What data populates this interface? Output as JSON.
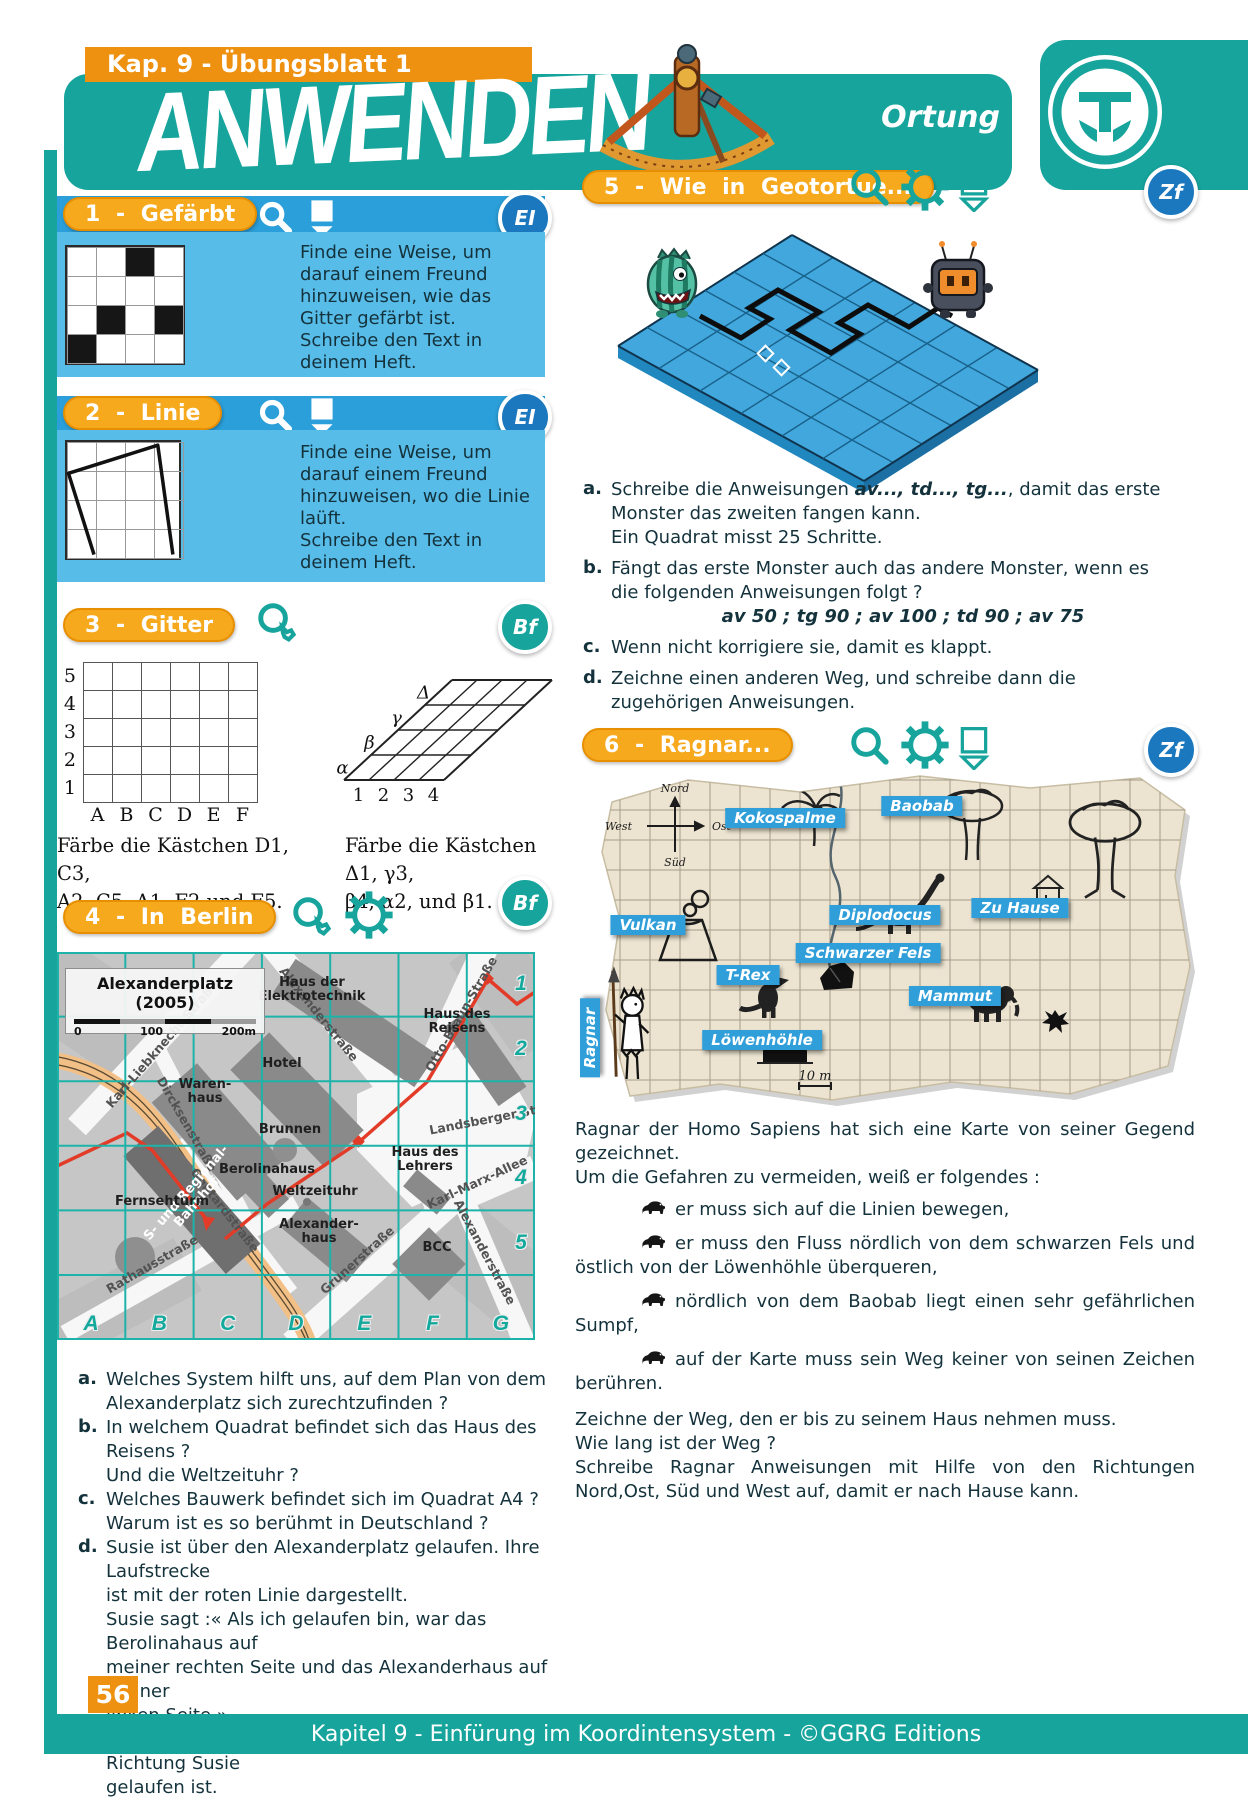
{
  "page": {
    "banner": "Kap. 9 - Übungsblatt 1",
    "title": "ANWENDEN",
    "subtitle": "Ortung",
    "page_number": "56",
    "footer": "Kapitel 9 - Einfürung im Koordintensystem - ©GGRG Editions"
  },
  "palette": {
    "teal": "#16a49c",
    "orange": "#ef9110",
    "pill": "#f6a91d",
    "blue_bar": "#2b9fd9",
    "blue_box": "#58bce8",
    "badge_blue": "#1b78be",
    "text": "#14323c",
    "map_grid": "#1db3a8",
    "red_route": "#e23b28"
  },
  "ex1": {
    "pill_label": "1 - Gefärbt",
    "badge": "EI",
    "icons": [
      "magnifier",
      "pencil"
    ],
    "text": [
      "Finde eine Weise, um",
      "darauf einem Freund",
      "hinzuweisen, wie das",
      "Gitter gefärbt ist.",
      "Schreibe den Text in",
      "deinem Heft."
    ],
    "grid": {
      "rows": 4,
      "cols": 4,
      "black": [
        [
          0,
          2
        ],
        [
          2,
          1
        ],
        [
          2,
          3
        ],
        [
          3,
          0
        ]
      ]
    }
  },
  "ex2": {
    "pill_label": "2 - Linie",
    "badge": "EI",
    "icons": [
      "magnifier",
      "pencil"
    ],
    "text": [
      "Finde eine Weise, um",
      "darauf einem Freund",
      "hinzuweisen, wo die Linie",
      "laüft.",
      "Schreibe den Text in",
      "deinem Heft."
    ],
    "grid": {
      "rows": 4,
      "cols": 4
    },
    "line": [
      [
        1.0,
        3.95
      ],
      [
        0.12,
        1.15
      ],
      [
        3.2,
        0.18
      ],
      [
        3.72,
        3.95
      ]
    ]
  },
  "ex3": {
    "pill_label": "3 - Gitter",
    "badge": "Bf",
    "icons": [
      "magnifier"
    ],
    "left_grid": {
      "col_labels": [
        "A",
        "B",
        "C",
        "D",
        "E",
        "F"
      ],
      "row_labels": [
        "5",
        "4",
        "3",
        "2",
        "1"
      ]
    },
    "right_grid": {
      "col_labels": [
        "1",
        "2",
        "3",
        "4"
      ],
      "row_labels": [
        "α",
        "β",
        "γ",
        "Δ"
      ]
    },
    "caption_left": [
      "Färbe die Kästchen D1, C3,",
      "A2, C5, A1, F2 und F5."
    ],
    "caption_right": [
      "Färbe die Kästchen Δ1, γ3,",
      "β4, α2, und β1."
    ]
  },
  "ex4": {
    "pill_label": "4 - In Berlin",
    "badge": "Bf",
    "icons": [
      "magnifier",
      "gear"
    ],
    "map": {
      "title": "Alexanderplatz (2005)",
      "scale": [
        "0",
        "100",
        "200m"
      ],
      "letters": [
        "A",
        "B",
        "C",
        "D",
        "E",
        "F",
        "G"
      ],
      "numbers": [
        "1",
        "2",
        "3",
        "4",
        "5"
      ],
      "streets": [
        {
          "label": "Karl-Liebknecht-Straße",
          "x": 105,
          "y": 92,
          "rot": -49
        },
        {
          "label": "Dircksenstraße",
          "x": 130,
          "y": 172,
          "rot": 60
        },
        {
          "label": "Gontardstraße",
          "x": 168,
          "y": 258,
          "rot": 52
        },
        {
          "label": "Rathausstraße",
          "x": 95,
          "y": 312,
          "rot": -30
        },
        {
          "label": "Alexanderstraße",
          "x": 262,
          "y": 62,
          "rot": 51
        },
        {
          "label": "Otto-Braun-Straße",
          "x": 404,
          "y": 62,
          "rot": -60
        },
        {
          "label": "Landsberger Str.",
          "x": 430,
          "y": 167,
          "rot": -11
        },
        {
          "label": "Karl-Marx-Allee",
          "x": 420,
          "y": 230,
          "rot": -25
        },
        {
          "label": "Grunerstraße",
          "x": 300,
          "y": 308,
          "rot": -42
        },
        {
          "label": "Alexanderstraße",
          "x": 428,
          "y": 300,
          "rot": 62
        }
      ],
      "buildings": [
        {
          "label": "Haus der\nElektrotechnik",
          "x": 255,
          "y": 38,
          "rot": 0
        },
        {
          "label": "Haus des\nReisens",
          "x": 400,
          "y": 70,
          "rot": 0
        },
        {
          "label": "Hotel",
          "x": 225,
          "y": 112,
          "rot": 0
        },
        {
          "label": "Waren-\nhaus",
          "x": 148,
          "y": 140,
          "rot": 0
        },
        {
          "label": "Brunnen",
          "x": 233,
          "y": 178,
          "rot": 0
        },
        {
          "label": "Berolinahaus",
          "x": 210,
          "y": 218,
          "rot": 0
        },
        {
          "label": "S- und Regional-\nBahnhof",
          "x": 135,
          "y": 246,
          "rot": -49,
          "white": true
        },
        {
          "label": "Fernsehturm",
          "x": 105,
          "y": 250,
          "rot": 0
        },
        {
          "label": "Weltzeituhr",
          "x": 258,
          "y": 240,
          "rot": 0
        },
        {
          "label": "Alexander-\nhaus",
          "x": 262,
          "y": 280,
          "rot": 0
        },
        {
          "label": "BCC",
          "x": 380,
          "y": 296,
          "rot": 0
        },
        {
          "label": "Haus des Lehrers",
          "x": 368,
          "y": 208,
          "rot": 0
        }
      ]
    },
    "questions": [
      {
        "key": "a.",
        "lines": [
          "Welches System hilft uns, auf dem Plan von dem",
          "Alexanderplatz sich zurechtzufinden ?"
        ]
      },
      {
        "key": "b.",
        "lines": [
          "In welchem Quadrat befindet sich das Haus des Reisens ?",
          "Und die Weltzeituhr ?"
        ]
      },
      {
        "key": "c.",
        "lines": [
          "Welches Bauwerk befindet sich im Quadrat A4 ?",
          "Warum ist es so berühmt in Deutschland ?"
        ]
      },
      {
        "key": "d.",
        "lines": [
          "Susie ist über den Alexanderplatz gelaufen. Ihre Laufstrecke",
          "ist mit der roten Linie dargestellt.",
          "Susie sagt :« Als ich gelaufen bin, war das Berolinahaus auf",
          "meiner rechten Seite und das Alexanderhaus auf meiner",
          "linken Seite ».",
          "Zeichne ein Pfeil, um zu zeigen, in welcher Richtung Susie",
          "gelaufen ist."
        ]
      }
    ]
  },
  "ex5": {
    "pill_label": "5 - Wie in Geotortue...",
    "badge": "Zf",
    "icons": [
      "magnifier",
      "gear",
      "pencil"
    ],
    "items": [
      {
        "key": "a.",
        "lines": [
          [
            {
              "t": "Schreibe die Anweisungen "
            },
            {
              "b": "av..., td..., tg..."
            },
            {
              "t": ", damit das erste"
            }
          ],
          [
            {
              "t": "Monster das zweiten fangen kann."
            }
          ],
          [
            {
              "t": "Ein Quadrat misst 25 Schritte."
            }
          ]
        ]
      },
      {
        "key": "b.",
        "lines": [
          [
            {
              "t": "Fängt das erste Monster auch das andere Monster, wenn es"
            }
          ],
          [
            {
              "t": "die folgenden Anweisungen folgt ?"
            }
          ],
          [
            {
              "c": "av 50 ; tg 90 ; av 100 ; td 90 ; av 75"
            }
          ]
        ]
      },
      {
        "key": "c.",
        "lines": [
          [
            {
              "t": "Wenn nicht korrigiere sie, damit es klappt."
            }
          ]
        ]
      },
      {
        "key": "d.",
        "lines": [
          [
            {
              "t": "Zeichne einen anderen Weg, und schreibe dann die"
            }
          ],
          [
            {
              "t": "zugehörigen Anweisungen."
            }
          ]
        ]
      }
    ]
  },
  "ex6": {
    "pill_label": "6 - Ragnar...",
    "badge": "Zf",
    "icons": [
      "magnifier",
      "gear",
      "pencil"
    ],
    "map": {
      "ribbons": [
        {
          "label": "Kokospalme",
          "x": 185,
          "y": 50
        },
        {
          "label": "Baobab",
          "x": 322,
          "y": 38
        },
        {
          "label": "Vulkan",
          "x": 48,
          "y": 157
        },
        {
          "label": "Diplodocus",
          "x": 285,
          "y": 147
        },
        {
          "label": "Zu Hause",
          "x": 420,
          "y": 140
        },
        {
          "label": "T-Rex",
          "x": 148,
          "y": 207
        },
        {
          "label": "Schwarzer Fels",
          "x": 268,
          "y": 185
        },
        {
          "label": "Mammut",
          "x": 355,
          "y": 228
        },
        {
          "label": "Löwenhöhle",
          "x": 162,
          "y": 272
        }
      ],
      "ragnar_label": "Ragnar",
      "compass": {
        "n": "Nord",
        "w": "West",
        "e": "Ost",
        "s": "Süd"
      },
      "scale": "10 m"
    },
    "intro": [
      "Ragnar der Homo Sapiens hat sich eine Karte von seiner Gegend gezeichnet.",
      "Um die Gefahren zu vermeiden, weiß er folgendes :"
    ],
    "bullets": [
      "er muss sich auf die Linien bewegen,",
      "er muss den Fluss  nördlich von dem schwarzen Fels und östlich von der Löwenhöhle überqueren,",
      "nördlich von dem Baobab liegt einen sehr gefährlichen Sumpf,",
      "auf der Karte muss sein Weg keiner von seinen Zeich­en berühren."
    ],
    "outro": [
      "Zeichne der Weg, den er bis zu seinem Haus nehmen muss.",
      "Wie lang ist der Weg ?",
      "Schreibe Ragnar Anweisungen mit Hilfe von den Richtungen Nord,Ost, Süd und West auf, damit er nach Hause kann."
    ]
  }
}
